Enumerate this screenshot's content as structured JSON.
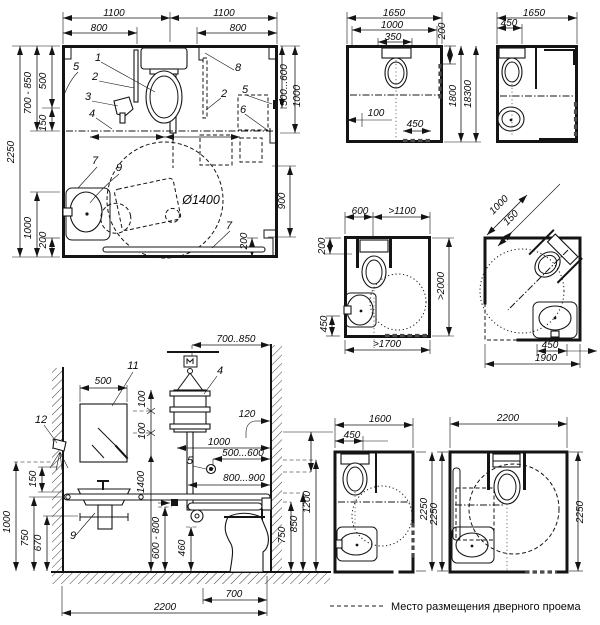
{
  "legend": {
    "label": "Место размещения дверного проема"
  },
  "diagrams": {
    "plan_corner_unit": {
      "labels": [
        {
          "t": "1100",
          "x": 114,
          "y": 16
        },
        {
          "t": "1100",
          "x": 224,
          "y": 16
        },
        {
          "t": "800",
          "x": 99,
          "y": 31
        },
        {
          "t": "800",
          "x": 238,
          "y": 31
        },
        {
          "t": "700 - 850",
          "x": 31,
          "y": 93,
          "r": -90
        },
        {
          "t": "500",
          "x": 46,
          "y": 81,
          "r": -90
        },
        {
          "t": "150",
          "x": 46,
          "y": 123,
          "r": -90
        },
        {
          "t": "2250",
          "x": 14,
          "y": 152,
          "r": -90
        },
        {
          "t": "1000",
          "x": 31,
          "y": 228,
          "r": -90
        },
        {
          "t": "200",
          "x": 46,
          "y": 240,
          "r": -90
        },
        {
          "t": "500...600",
          "x": 287,
          "y": 85,
          "r": -90
        },
        {
          "t": "1000",
          "x": 300,
          "y": 96,
          "r": -90
        },
        {
          "t": "900",
          "x": 285,
          "y": 201,
          "r": -90
        },
        {
          "t": "200",
          "x": 247,
          "y": 241,
          "r": -90
        },
        {
          "t": "Ø1400",
          "x": 201,
          "y": 204,
          "k": "note"
        },
        {
          "t": "1",
          "x": 98,
          "y": 61,
          "k": "call"
        },
        {
          "t": "2",
          "x": 95,
          "y": 80,
          "k": "call"
        },
        {
          "t": "3",
          "x": 88,
          "y": 100,
          "k": "call"
        },
        {
          "t": "4",
          "x": 92,
          "y": 117,
          "k": "call"
        },
        {
          "t": "5",
          "x": 76,
          "y": 70,
          "k": "call"
        },
        {
          "t": "8",
          "x": 238,
          "y": 71,
          "k": "call"
        },
        {
          "t": "2",
          "x": 224,
          "y": 97,
          "k": "call"
        },
        {
          "t": "5",
          "x": 245,
          "y": 93,
          "k": "call"
        },
        {
          "t": "6",
          "x": 243,
          "y": 113,
          "k": "call"
        },
        {
          "t": "7",
          "x": 95,
          "y": 164,
          "k": "call"
        },
        {
          "t": "9",
          "x": 119,
          "y": 171,
          "k": "call"
        },
        {
          "t": "7",
          "x": 229,
          "y": 229,
          "k": "call"
        }
      ]
    },
    "plan_1650_a": {
      "labels": [
        {
          "t": "1650",
          "x": 394,
          "y": 16
        },
        {
          "t": "1000",
          "x": 392,
          "y": 28
        },
        {
          "t": "350",
          "x": 393,
          "y": 40
        },
        {
          "t": "200",
          "x": 445,
          "y": 31,
          "r": -90
        },
        {
          "t": "1800",
          "x": 456,
          "y": 96,
          "r": -90
        },
        {
          "t": "18300",
          "x": 471,
          "y": 94,
          "r": -90
        },
        {
          "t": "100",
          "x": 376,
          "y": 116
        },
        {
          "t": "450",
          "x": 415,
          "y": 127
        }
      ]
    },
    "plan_1650_b": {
      "labels": [
        {
          "t": "1650",
          "x": 534,
          "y": 16
        },
        {
          "t": "450",
          "x": 509,
          "y": 26
        }
      ]
    },
    "plan_min_wc": {
      "labels": [
        {
          "t": "600",
          "x": 360,
          "y": 214
        },
        {
          "t": ">1100",
          "x": 402,
          "y": 214
        },
        {
          "t": "200",
          "x": 325,
          "y": 246,
          "r": -90
        },
        {
          "t": ">2000",
          "x": 444,
          "y": 286,
          "r": -90
        },
        {
          "t": "450",
          "x": 327,
          "y": 324,
          "r": -90
        },
        {
          "t": ">1700",
          "x": 387,
          "y": 347
        }
      ]
    },
    "plan_corner_wc": {
      "labels": [
        {
          "t": "1000",
          "x": 501,
          "y": 207,
          "r": -45
        },
        {
          "t": "150",
          "x": 513,
          "y": 220,
          "r": -45
        },
        {
          "t": "450",
          "x": 550,
          "y": 348
        },
        {
          "t": "1900",
          "x": 546,
          "y": 361
        }
      ]
    },
    "elevation": {
      "labels": [
        {
          "t": "700..850",
          "x": 236,
          "y": 342
        },
        {
          "t": "500",
          "x": 103,
          "y": 384
        },
        {
          "t": "11",
          "x": 133,
          "y": 369,
          "k": "call"
        },
        {
          "t": "12",
          "x": 41,
          "y": 423,
          "k": "call"
        },
        {
          "t": "100",
          "x": 145,
          "y": 399,
          "r": -90
        },
        {
          "t": "100",
          "x": 145,
          "y": 431,
          "r": -90
        },
        {
          "t": "4",
          "x": 220,
          "y": 374,
          "k": "call"
        },
        {
          "t": "120",
          "x": 247,
          "y": 417
        },
        {
          "t": "1000",
          "x": 219,
          "y": 445
        },
        {
          "t": "500...600",
          "x": 243,
          "y": 456
        },
        {
          "t": "5",
          "x": 190,
          "y": 464,
          "k": "call"
        },
        {
          "t": "800...900",
          "x": 244,
          "y": 481
        },
        {
          "t": "1400",
          "x": 144,
          "y": 482,
          "r": -90
        },
        {
          "t": "150",
          "x": 36,
          "y": 479,
          "r": -90
        },
        {
          "t": "1000",
          "x": 10,
          "y": 522,
          "r": -90
        },
        {
          "t": "750",
          "x": 28,
          "y": 538,
          "r": -90
        },
        {
          "t": "670",
          "x": 41,
          "y": 543,
          "r": -90
        },
        {
          "t": "9",
          "x": 73,
          "y": 539,
          "k": "call"
        },
        {
          "t": "600 - 800",
          "x": 159,
          "y": 538,
          "r": -90
        },
        {
          "t": "460",
          "x": 185,
          "y": 548,
          "r": -90
        },
        {
          "t": "750",
          "x": 285,
          "y": 535,
          "r": -90
        },
        {
          "t": "850",
          "x": 297,
          "y": 524,
          "r": -90
        },
        {
          "t": "1200",
          "x": 310,
          "y": 502,
          "r": -90
        },
        {
          "t": "700",
          "x": 234,
          "y": 597
        },
        {
          "t": "2200",
          "x": 165,
          "y": 610
        }
      ]
    },
    "plan_1600": {
      "labels": [
        {
          "t": "1600",
          "x": 380,
          "y": 422
        },
        {
          "t": "450",
          "x": 352,
          "y": 438
        },
        {
          "t": "2250",
          "x": 427,
          "y": 509,
          "r": -90
        }
      ]
    },
    "plan_2200": {
      "labels": [
        {
          "t": "2200",
          "x": 508,
          "y": 421
        },
        {
          "t": "2250",
          "x": 437,
          "y": 514,
          "r": -90
        },
        {
          "t": "2250",
          "x": 583,
          "y": 512,
          "r": -90
        }
      ]
    }
  }
}
